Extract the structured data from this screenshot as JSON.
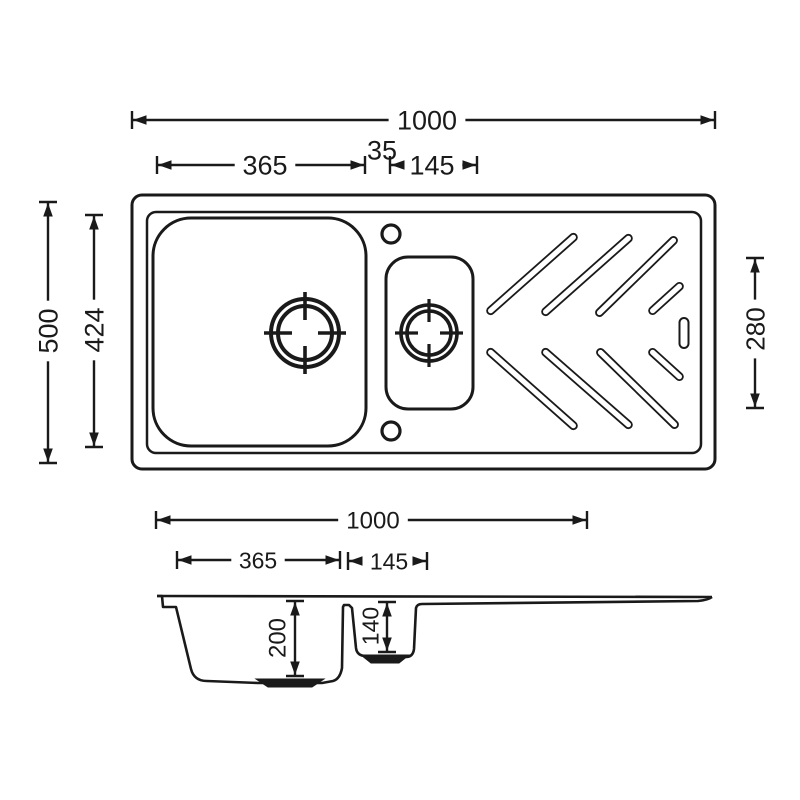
{
  "meta": {
    "drawing_type": "sink-dimension-diagram",
    "canvas": {
      "w": 800,
      "h": 800
    },
    "colors": {
      "line": "#1a1a1a",
      "bg": "#ffffff"
    }
  },
  "measurements": {
    "overall_width_mm": "1000",
    "large_bowl_width_mm": "365",
    "divider_width_mm": "35",
    "small_bowl_width_mm": "145",
    "overall_depth_mm": "500",
    "inner_depth_mm": "424",
    "drainer_length_mm": "280",
    "large_bowl_depth_mm": "200",
    "small_bowl_depth_mm": "140"
  },
  "top_view": {
    "outer_rect": {
      "x": 132,
      "y": 195,
      "w": 583,
      "h": 274,
      "r": 10,
      "sw": 3
    },
    "inner_rect": {
      "x": 147,
      "y": 212,
      "w": 554,
      "h": 241,
      "r": 9,
      "sw": 2.5
    },
    "large_bowl": {
      "x": 153,
      "y": 218,
      "w": 213,
      "h": 228,
      "r": 38,
      "sw": 3
    },
    "small_bowl": {
      "x": 386,
      "y": 257,
      "w": 87,
      "h": 152,
      "r": 22,
      "sw": 3
    },
    "drains": [
      {
        "kind": "large-bowl-drain",
        "cx": 305,
        "cy": 333,
        "r_outer": 34,
        "r_inner": 27,
        "tick_in": 13,
        "tick_out": 41,
        "sw": 4,
        "tick_sw": 3.6
      },
      {
        "kind": "small-bowl-drain",
        "cx": 429,
        "cy": 333,
        "r_outer": 28,
        "r_inner": 22,
        "tick_in": 11,
        "tick_out": 34,
        "sw": 3.6,
        "tick_sw": 3.2
      }
    ],
    "tap_holes": [
      {
        "cx": 391,
        "cy": 234,
        "r": 9,
        "sw": 3.2
      },
      {
        "cx": 391,
        "cy": 431,
        "r": 9,
        "sw": 3.2
      }
    ],
    "grooves": {
      "slot_width": 7,
      "sw": 1.8,
      "lines": [
        [
          488,
          313,
          576,
          235
        ],
        [
          543,
          314,
          631,
          236
        ],
        [
          597,
          315,
          676,
          238
        ],
        [
          650,
          313,
          682,
          284
        ],
        [
          488,
          350,
          576,
          428
        ],
        [
          543,
          350,
          631,
          427
        ],
        [
          598,
          350,
          677,
          427
        ],
        [
          650,
          350,
          682,
          379
        ]
      ]
    },
    "overflow_slot": {
      "cx": 684,
      "cy": 333,
      "w": 9,
      "h": 30,
      "sw": 2
    }
  },
  "side_view": {
    "top_line": {
      "x1": 157,
      "y1": 596,
      "x2": 712,
      "y2": 597,
      "sw": 2.6
    },
    "profile_sw": 2.6,
    "profile_d": "M 157,596 L 162,596 L 163,607 L 176,607 L 191,669 Q 194,681 207,681 L 258,683 L 322,683 L 333,681 Q 340,679 342,668 L 343,607 L 344,605 L 349,605 L 352,608 L 356,648 Q 357,656 366,656 L 406,657 Q 413,657 414,649 L 416,608 Q 417,604 422,604 L 698,601 Q 708,600 712,597",
    "drain_bumps": [
      "M 256,679 L 324,679 L 312,687 L 268,687 Z",
      "M 361,655 L 409,655 L 399,663 L 371,663 Z"
    ]
  },
  "dims": {
    "arrow_len": 13.5,
    "arrow_w": 4.8,
    "line_sw": 2.4,
    "tick_half": 9,
    "horizontal": [
      {
        "name": "overall-width-top",
        "label": "1000",
        "x1": 132,
        "x2": 715,
        "y": 120,
        "lx": 427,
        "fs": 27
      },
      {
        "name": "large-bowl-width-top",
        "label": "365",
        "x1": 157,
        "x2": 365,
        "y": 165,
        "lx": 265,
        "fs": 27
      },
      {
        "name": "small-bowl-width-top",
        "label": "145",
        "x1": 390,
        "x2": 477,
        "y": 165,
        "lx": 432,
        "fs": 27
      },
      {
        "name": "overall-width-side",
        "label": "1000",
        "x1": 156,
        "x2": 587,
        "y": 520,
        "lx": 373,
        "fs": 24
      },
      {
        "name": "large-bowl-width-side",
        "label": "365",
        "x1": 177,
        "x2": 340,
        "y": 560,
        "lx": 258,
        "fs": 23
      },
      {
        "name": "small-bowl-width-side",
        "label": "145",
        "x1": 348,
        "x2": 427,
        "y": 561,
        "lx": 389,
        "fs": 23
      }
    ],
    "vertical": [
      {
        "name": "overall-depth",
        "label": "500",
        "x": 48,
        "y1": 202,
        "y2": 463,
        "ly": 331,
        "fs": 27
      },
      {
        "name": "inner-depth",
        "label": "424",
        "x": 94,
        "y1": 215,
        "y2": 447,
        "ly": 330,
        "fs": 27
      },
      {
        "name": "drainer-length",
        "label": "280",
        "x": 755,
        "y1": 258,
        "y2": 408,
        "ly": 329,
        "fs": 26
      },
      {
        "name": "large-bowl-depth",
        "label": "200",
        "x": 295,
        "y1": 601,
        "y2": 676,
        "ly": 638,
        "lx": 277,
        "fs": 24
      },
      {
        "name": "small-bowl-depth",
        "label": "140",
        "x": 387,
        "y1": 602,
        "y2": 652,
        "ly": 626,
        "lx": 370,
        "fs": 23
      }
    ],
    "floating": [
      {
        "name": "divider-width-top",
        "label": "35",
        "x": 382,
        "y": 150,
        "fs": 27
      }
    ]
  }
}
